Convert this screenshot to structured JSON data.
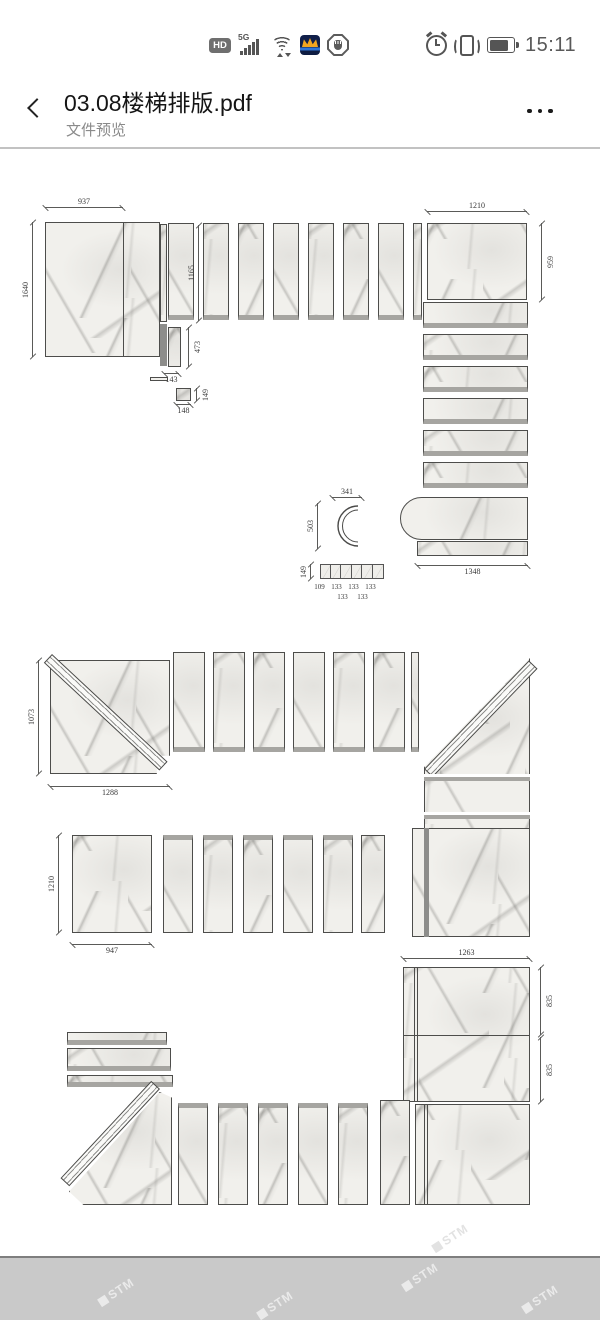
{
  "status_bar": {
    "time": "15:11",
    "hd_label": "HD",
    "network_label": "5G",
    "icons": [
      "hd-badge",
      "signal-strength-icon",
      "wifi-icon",
      "app-notification-icon",
      "do-not-disturb-icon",
      "alarm-icon",
      "vibrate-icon",
      "battery-icon"
    ]
  },
  "header": {
    "title": "03.08楼梯排版.pdf",
    "subtitle": "文件预览"
  },
  "drawing": {
    "d1": {
      "slab_w": "937",
      "slab_h": "1640",
      "tread_h": "1165",
      "piece_h": "473",
      "piece_w": "143",
      "square_w": "148",
      "square_h": "149",
      "right_slab_w": "1210",
      "right_slab_h": "959",
      "curve_w": "341",
      "curve_h": "503",
      "bottom_w": "1348",
      "strip_h": "149",
      "strip_widths": [
        "109",
        "133",
        "133",
        "133",
        "133",
        "133"
      ]
    },
    "d2": {
      "slab_h": "1073",
      "slab_w": "1288"
    },
    "d3": {
      "slab_h": "1210",
      "slab_w": "947"
    },
    "d4": {
      "slab_w": "1263",
      "seg1_h": "835",
      "seg2_h": "835"
    }
  },
  "watermark": {
    "text": "STM"
  }
}
